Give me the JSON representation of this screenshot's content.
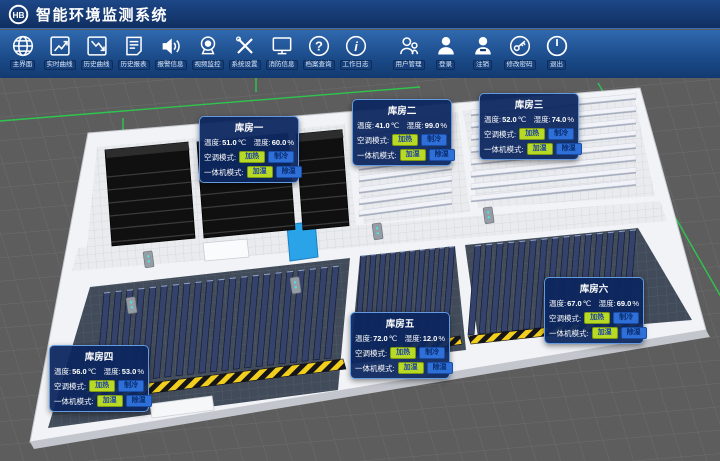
{
  "header": {
    "title": "智能环境监测系统",
    "logo_text": "HB"
  },
  "toolbar": {
    "items": [
      {
        "icon": "globe-icon",
        "label": "主界面"
      },
      {
        "icon": "trend-up-icon",
        "label": "实时曲线"
      },
      {
        "icon": "trend-down-icon",
        "label": "历史曲线"
      },
      {
        "icon": "report-icon",
        "label": "历史报表"
      },
      {
        "icon": "speaker-icon",
        "label": "报警信息"
      },
      {
        "icon": "camera-icon",
        "label": "视频监控"
      },
      {
        "icon": "tools-icon",
        "label": "系统设置"
      },
      {
        "icon": "monitor-icon",
        "label": "消防信息"
      },
      {
        "icon": "question-icon",
        "label": "档案查询"
      },
      {
        "icon": "info-icon",
        "label": "工作日志"
      },
      {
        "icon": "users-icon",
        "label": "用户管理"
      },
      {
        "icon": "user-icon",
        "label": "登录"
      },
      {
        "icon": "user-minus-icon",
        "label": "注销"
      },
      {
        "icon": "key-icon",
        "label": "修改密码"
      },
      {
        "icon": "power-icon",
        "label": "退出"
      }
    ]
  },
  "panels": {
    "labels": {
      "temp": "温度:",
      "hum": "湿度:",
      "temp_unit": "℃",
      "hum_unit": "%",
      "ac_mode": "空调模式:",
      "unit_mode": "一体机模式:",
      "heat": "加热",
      "cool": "制冷",
      "humidify": "加湿",
      "dehumidify": "除湿"
    },
    "rooms": [
      {
        "name": "库房一",
        "temp": "51.0",
        "hum": "60.0"
      },
      {
        "name": "库房二",
        "temp": "41.0",
        "hum": "99.0"
      },
      {
        "name": "库房三",
        "temp": "52.0",
        "hum": "74.0"
      },
      {
        "name": "库房四",
        "temp": "56.0",
        "hum": "53.0"
      },
      {
        "name": "库房五",
        "temp": "72.0",
        "hum": "12.0"
      },
      {
        "name": "库房六",
        "temp": "67.0",
        "hum": "69.0"
      }
    ]
  },
  "colors": {
    "header_bg": "#14356a",
    "toolbar_bg": "#1b4b89",
    "panel_bg": "#0d275f",
    "panel_border": "#639ae0",
    "btn_heat_bg": "#b9da25",
    "btn_heat_text": "#173da8",
    "btn_cool_bg": "#2e6fd8",
    "btn_cool_text": "#0a2d6e",
    "axis_green": "#29d14d",
    "scene_bg": "#5c5c5c",
    "slab_blue": "#35426b",
    "hazard_yellow": "#f2cf1d"
  }
}
